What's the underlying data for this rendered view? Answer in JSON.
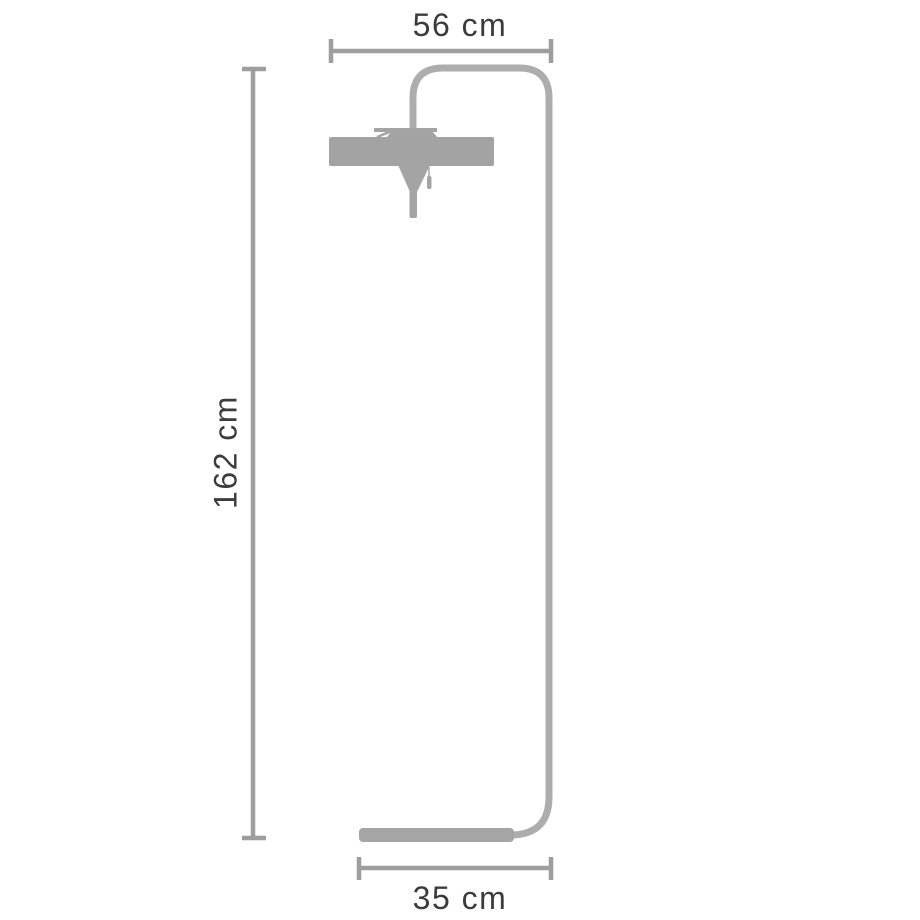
{
  "diagram": {
    "type": "product-dimension-diagram",
    "subject": "floor-lamp-outline",
    "dimensions": {
      "width_top": "56 cm",
      "height_left": "162 cm",
      "depth_bottom": "35 cm"
    }
  },
  "colors": {
    "background": "#ffffff",
    "label_text": "#3c3c3c",
    "dimension_line": "#9e9e9e",
    "lamp_tube": "#adadad",
    "lamp_shade": "#a3a3a3",
    "lamp_metal": "#a4a4a4",
    "lamp_base": "#a5a5a5"
  }
}
